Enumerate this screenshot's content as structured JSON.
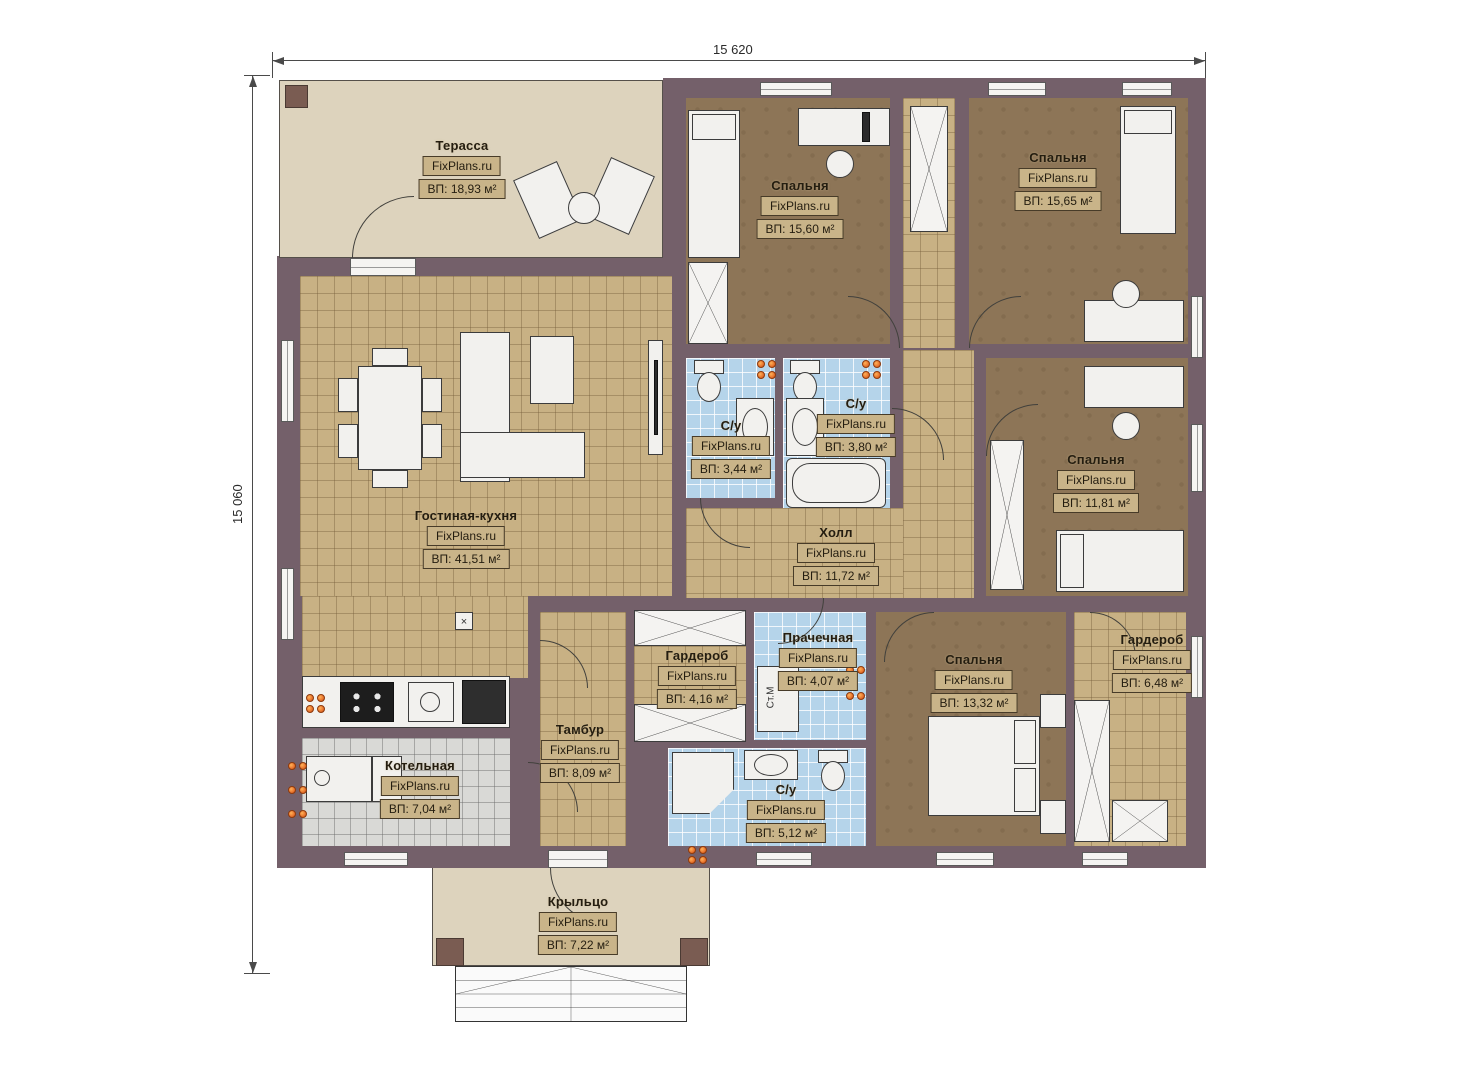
{
  "brand": "FixPlans.ru",
  "dimensions": {
    "width_label": "15 620",
    "height_label": "15 060"
  },
  "rooms": [
    {
      "name": "Терасса",
      "area": "ВП: 18,93 м²"
    },
    {
      "name": "Спальня",
      "area": "ВП: 15,60 м²"
    },
    {
      "name": "Спальня",
      "area": "ВП: 15,65 м²"
    },
    {
      "name": "С/у",
      "area": "ВП: 3,44 м²"
    },
    {
      "name": "С/у",
      "area": "ВП: 3,80 м²"
    },
    {
      "name": "Спальня",
      "area": "ВП: 11,81 м²"
    },
    {
      "name": "Гостиная-кухня",
      "area": "ВП: 41,51 м²"
    },
    {
      "name": "Холл",
      "area": "ВП: 11,72 м²"
    },
    {
      "name": "Гардероб",
      "area": "ВП: 4,16 м²"
    },
    {
      "name": "Прачечная",
      "area": "ВП: 4,07 м²"
    },
    {
      "name": "Спальня",
      "area": "ВП: 13,32 м²"
    },
    {
      "name": "Гардероб",
      "area": "ВП: 6,48 м²"
    },
    {
      "name": "Тамбур",
      "area": "ВП: 8,09 м²"
    },
    {
      "name": "Котельная",
      "area": "ВП: 7,04 м²"
    },
    {
      "name": "С/у",
      "area": "ВП: 5,12 м²"
    },
    {
      "name": "Крыльцо",
      "area": "ВП: 7,22 м²"
    }
  ],
  "appliances": {
    "washing_machine": "Ст.М"
  },
  "symbols": {
    "vent": "×"
  },
  "colors": {
    "wall": "#74606a",
    "wall_post": "#7a5c52",
    "floor_tan": "#c8b184",
    "floor_brown": "#8d7557",
    "floor_blue": "#b5d4ea",
    "floor_grey": "#d9d9d6",
    "floor_beige": "#ddd3bd",
    "socket_accent": "#e8732e",
    "label_box_bg": "#c9b489",
    "label_border": "#473b28"
  }
}
